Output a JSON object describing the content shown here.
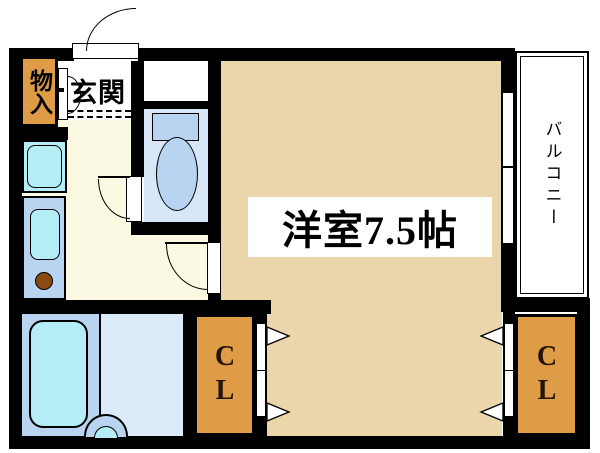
{
  "floorplan": {
    "rooms": {
      "storage": {
        "label": "物入"
      },
      "entrance": {
        "label": "玄関"
      },
      "main_room": {
        "label": "洋室7.5帖",
        "size_tatami": "7.5"
      },
      "balcony": {
        "label": "バルコニー"
      },
      "closet_left": {
        "label": "CL"
      },
      "closet_right": {
        "label": "CL"
      }
    },
    "icons": [
      "toilet-icon",
      "bathtub-icon",
      "washbasin-icon",
      "kitchen-sink-icon",
      "stove-burner-icon",
      "washing-machine-pan-icon",
      "entrance-door-icon",
      "toilet-door-icon",
      "room-door-icon",
      "storage-bifold-door-icon",
      "folding-door-arrow",
      "sliding-window-icon"
    ],
    "colors": {
      "wall": "#000000",
      "main_floor": "#ebd5ab",
      "closet": "#df9c47",
      "hall": "#fcf9e2",
      "genkan": "#ffffff",
      "toilet_floor": "#d8e7f8",
      "wet_floor": "#dcebfa",
      "fixture_blue": "#b9d4f0",
      "fixture_cyan": "#b4edf5",
      "burner": "#8a4a12"
    }
  }
}
